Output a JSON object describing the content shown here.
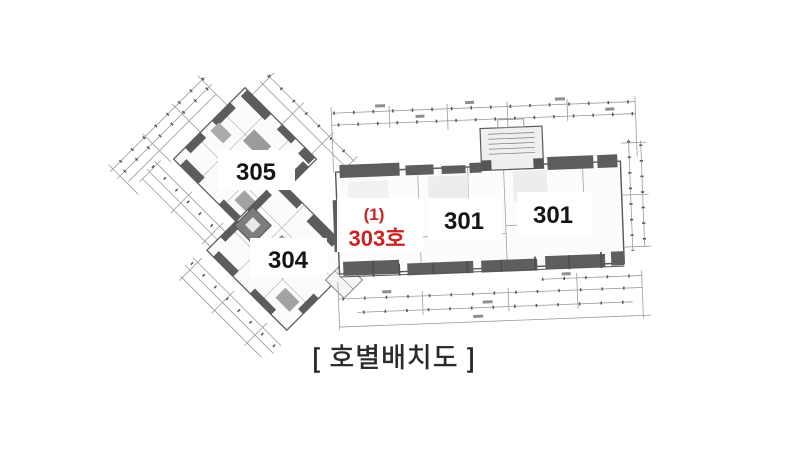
{
  "floor_plan": {
    "caption": "[ 호별배치도 ]",
    "units": {
      "unit_305": "305",
      "unit_304": "304",
      "unit_301_left": "301",
      "unit_301_right": "301"
    },
    "highlighted_unit": {
      "index_label": "(1)",
      "name_label": "303호",
      "text_color": "#cc2222"
    },
    "colors": {
      "background": "#ffffff",
      "drawing_line": "#9c9c9c",
      "wall_fill": "#5c5c5c",
      "unit_label_text": "#151515",
      "caption_text": "#2a2a2a"
    }
  }
}
